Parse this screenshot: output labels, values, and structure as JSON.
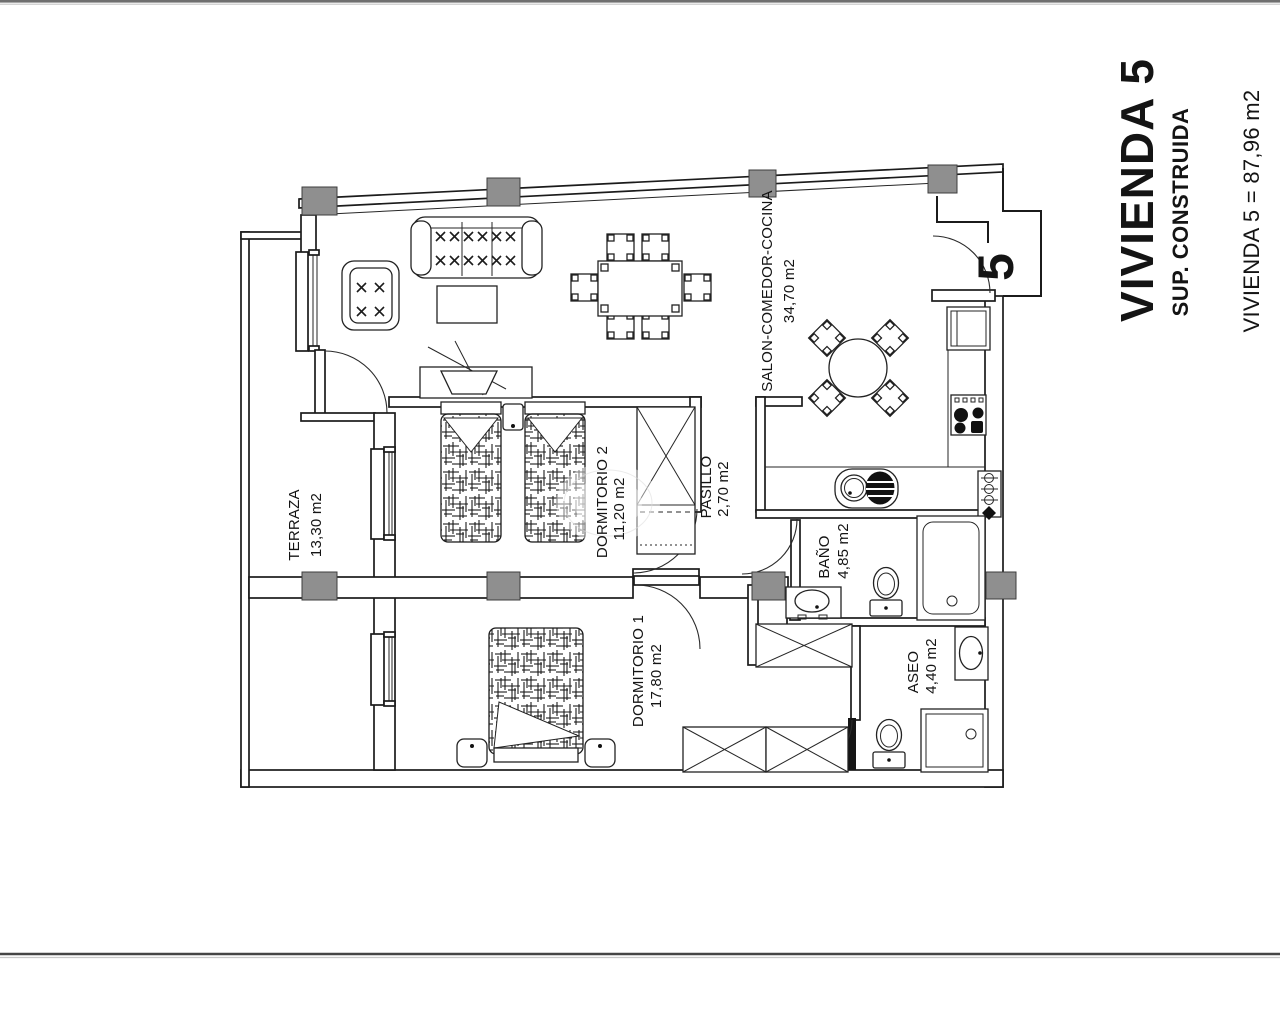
{
  "page": {
    "title_block": {
      "unit_title": "VIVIENDA 5",
      "subtitle": "SUP. CONSTRUIDA",
      "area_line": "VIVIENDA 5 = 87,96 m2"
    },
    "unit_number": "5",
    "rooms": [
      {
        "name": "TERRAZA",
        "area": "13,30 m2"
      },
      {
        "name": "SALON-COMEDOR-COCINA",
        "area": "34,70 m2"
      },
      {
        "name": "DORMITORIO 2",
        "area": "11,20 m2"
      },
      {
        "name": "PASILLO",
        "area": "2,70 m2"
      },
      {
        "name": "BAÑO",
        "area": "4,85 m2"
      },
      {
        "name": "DORMITORIO 1",
        "area": "17,80 m2"
      },
      {
        "name": "ASEO",
        "area": "4,40 m2"
      }
    ],
    "colors": {
      "column_gray": "#8f8f8f",
      "line_black": "#1b1b1b"
    }
  }
}
